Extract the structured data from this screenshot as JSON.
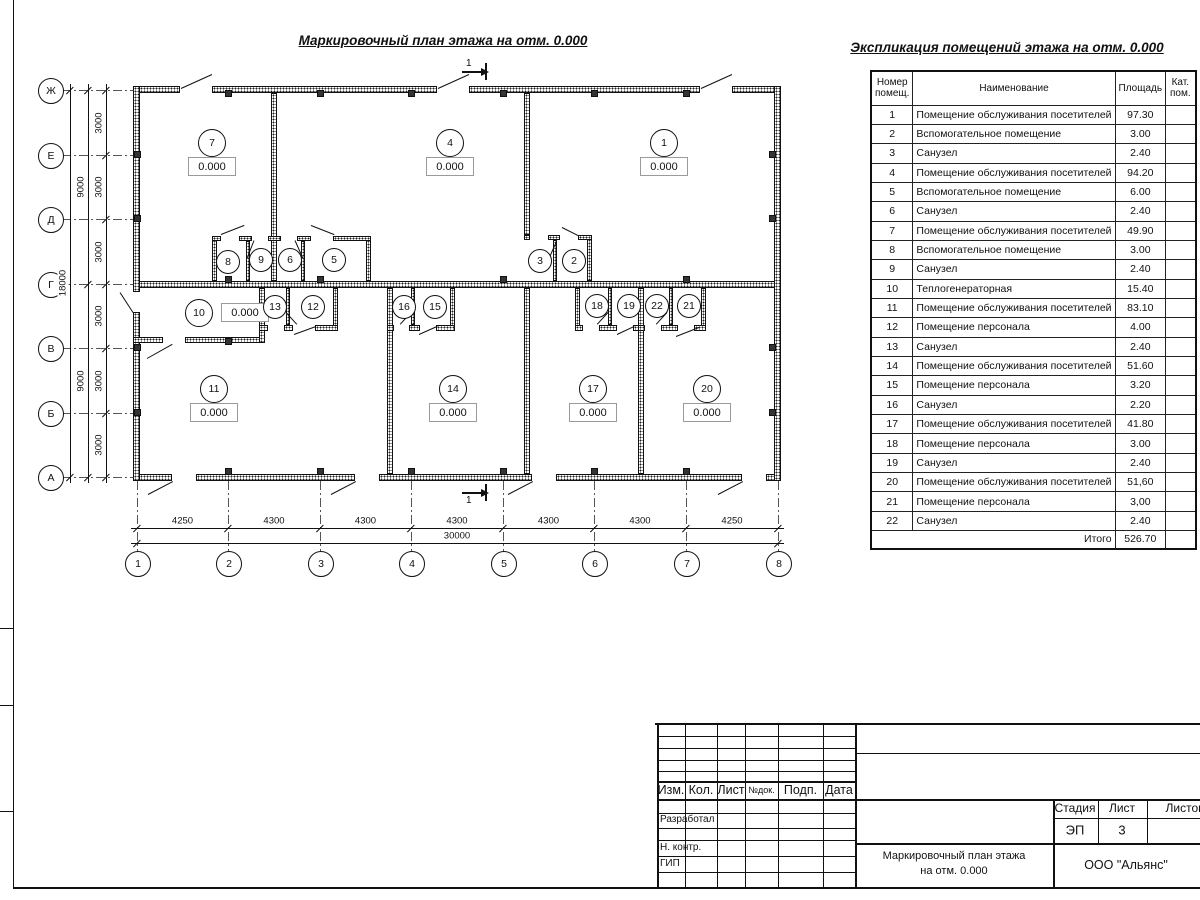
{
  "titles": {
    "plan": "Маркировочный план этажа на отм. 0.000",
    "table": "Экспликация помещений этажа на отм. 0.000"
  },
  "expl_table": {
    "col_headers": {
      "num": "Номер\nпомещ.",
      "name": "Наименование",
      "area": "Площадь",
      "cat": "Кат.\nпом."
    },
    "rows": [
      [
        "1",
        "Помещение обслуживания посетителей",
        "97.30"
      ],
      [
        "2",
        "Вспомогательное помещение",
        "3.00"
      ],
      [
        "3",
        "Санузел",
        "2.40"
      ],
      [
        "4",
        "Помещение обслуживания посетителей",
        "94.20"
      ],
      [
        "5",
        "Вспомогательное помещение",
        "6.00"
      ],
      [
        "6",
        "Санузел",
        "2.40"
      ],
      [
        "7",
        "Помещение обслуживания посетителей",
        "49.90"
      ],
      [
        "8",
        "Вспомогательное помещение",
        "3.00"
      ],
      [
        "9",
        "Санузел",
        "2.40"
      ],
      [
        "10",
        "Теплогенераторная",
        "15.40"
      ],
      [
        "11",
        "Помещение обслуживания посетителей",
        "83.10"
      ],
      [
        "12",
        "Помещение персонала",
        "4.00"
      ],
      [
        "13",
        "Санузел",
        "2.40"
      ],
      [
        "14",
        "Помещение обслуживания посетителей",
        "51.60"
      ],
      [
        "15",
        "Помещение персонала",
        "3.20"
      ],
      [
        "16",
        "Санузел",
        "2.20"
      ],
      [
        "17",
        "Помещение обслуживания посетителей",
        "41.80"
      ],
      [
        "18",
        "Помещение персонала",
        "3.00"
      ],
      [
        "19",
        "Санузел",
        "2.40"
      ],
      [
        "20",
        "Помещение обслуживания посетителей",
        "51,60"
      ],
      [
        "21",
        "Помещение персонала",
        "3,00"
      ],
      [
        "22",
        "Санузел",
        "2.40"
      ]
    ],
    "total_label": "Итого",
    "total_value": "526.70"
  },
  "axes": {
    "letters": [
      "Ж",
      "Е",
      "Д",
      "Г",
      "В",
      "Б",
      "А"
    ],
    "numbers": [
      "1",
      "2",
      "3",
      "4",
      "5",
      "6",
      "7",
      "8"
    ]
  },
  "dimensions": {
    "vertical_inner": [
      "3000",
      "3000",
      "3000",
      "3000",
      "3000",
      "3000"
    ],
    "vertical_mid": [
      "9000",
      "9000"
    ],
    "vertical_total": "18000",
    "horizontal": [
      "4250",
      "4300",
      "4300",
      "4300",
      "4300",
      "4300",
      "4250"
    ],
    "horizontal_total": "30000"
  },
  "section_mark": "1",
  "level_value": "0.000",
  "rooms": {
    "with_level": [
      "7",
      "4",
      "1",
      "10",
      "11",
      "14",
      "17",
      "20"
    ],
    "small": [
      "8",
      "9",
      "6",
      "5",
      "3",
      "2",
      "13",
      "12",
      "16",
      "15",
      "18",
      "19",
      "22",
      "21"
    ]
  },
  "titleblock": {
    "cols": [
      "Изм.",
      "Кол.",
      "Лист",
      "№док.",
      "Подп.",
      "Дата"
    ],
    "row_labels": [
      "Разработал",
      "Н. контр.",
      "ГИП"
    ],
    "stage_label": "Стадия",
    "sheet_label": "Лист",
    "sheets_label": "Листов",
    "stage": "ЭП",
    "sheet": "3",
    "doc_title": "Маркировочный план этажа\nна отм. 0.000",
    "company": "ООО \"Альянс\""
  }
}
